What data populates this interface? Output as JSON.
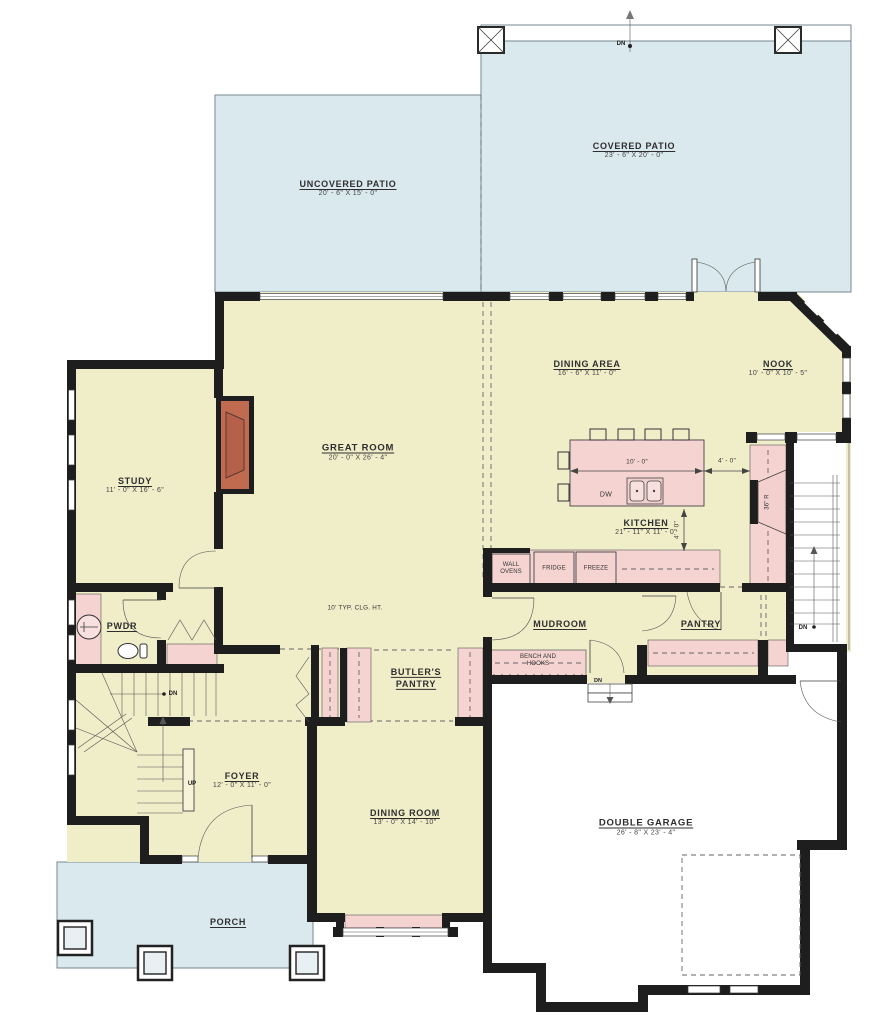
{
  "plan": {
    "type": "main-level-floor-plan",
    "colors": {
      "room_fill": "#F0EDC9",
      "cabinet_fill": "#F5D3D1",
      "patio_fill": "#DAE9EE",
      "garage_fill": "#FFFFFF",
      "wall": "#1E1E1E",
      "fireplace": "#C06A4F",
      "text": "#2E2E2E"
    },
    "rooms": {
      "covered_patio": {
        "name": "COVERED PATIO",
        "dims": "23' - 6\" X 20' - 0\""
      },
      "uncovered_patio": {
        "name": "UNCOVERED PATIO",
        "dims": "20' - 6\" X 15' - 0\""
      },
      "great_room": {
        "name": "GREAT ROOM",
        "dims": "20' - 0\" X 26' - 4\""
      },
      "dining_area": {
        "name": "DINING AREA",
        "dims": "16' - 6\" X 11' - 0\""
      },
      "nook": {
        "name": "NOOK",
        "dims": "10' - 0\" X 10' - 5\""
      },
      "kitchen": {
        "name": "KITCHEN",
        "dims": "21' - 11\" X 11' - 0\""
      },
      "study": {
        "name": "STUDY",
        "dims": "11' - 0\" X 16' - 6\""
      },
      "pwdr": {
        "name": "PWDR"
      },
      "mudroom": {
        "name": "MUDROOM"
      },
      "pantry": {
        "name": "PANTRY"
      },
      "butlers_pantry": {
        "name": "BUTLER'S PANTRY"
      },
      "foyer": {
        "name": "FOYER",
        "dims": "12' - 0\" X 11' - 0\""
      },
      "dining_room": {
        "name": "DINING ROOM",
        "dims": "13' - 0\" X 14' - 10\""
      },
      "double_garage": {
        "name": "DOUBLE GARAGE",
        "dims": "26' - 8\" X 23' - 4\""
      },
      "porch": {
        "name": "PORCH"
      }
    },
    "labels": {
      "ceiling_note": "10' TYP. CLG. HT.",
      "bench_line1": "BENCH AND",
      "bench_line2": "HOOKS",
      "dw": "DW",
      "wall_ovens_line1": "WALL",
      "wall_ovens_line2": "OVENS",
      "fridge": "FRIDGE",
      "freeze": "FREEZE",
      "range": "36\" R",
      "dim_island_width": "10' - 0\"",
      "dim_island_to_counter": "4' - 0\"",
      "dim_island_depth": "4' - 0\"",
      "up": "UP",
      "dn": "DN"
    }
  }
}
